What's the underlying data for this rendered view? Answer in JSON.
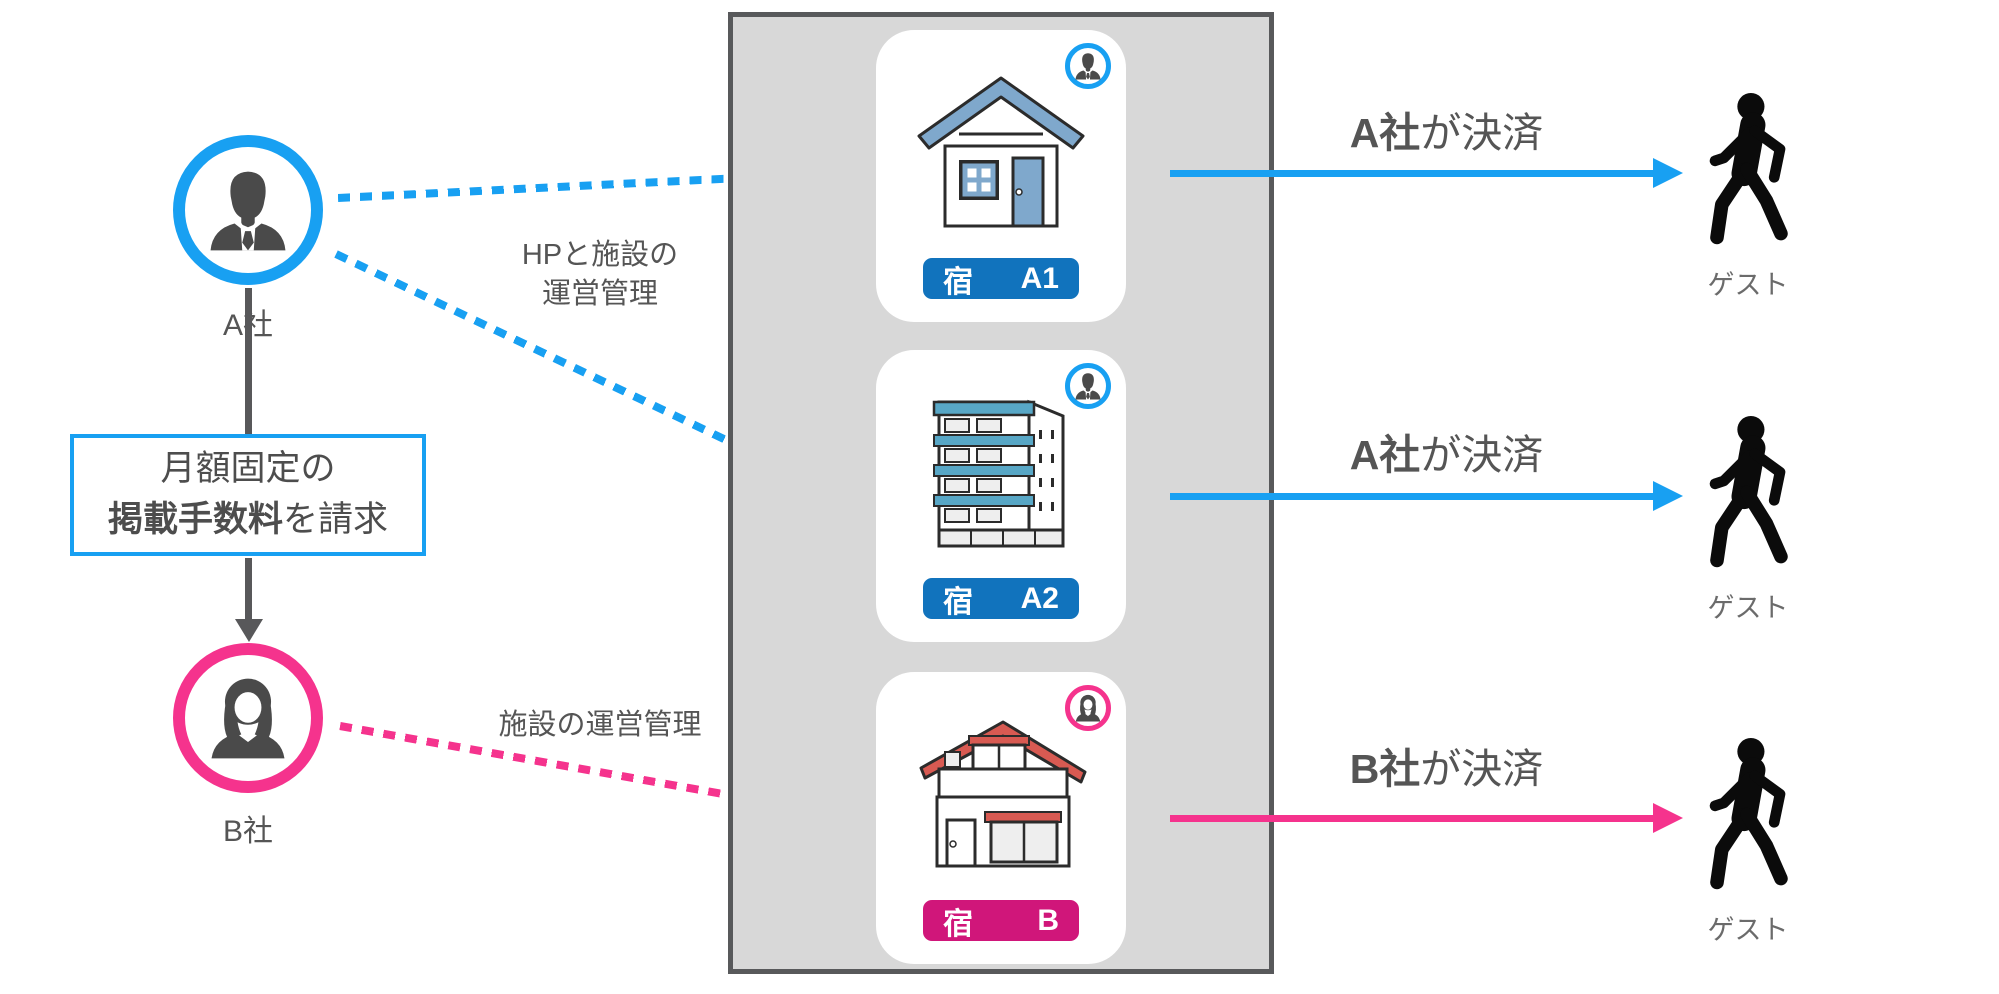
{
  "colors": {
    "blue": "#18A0F2",
    "pink": "#F5338D",
    "pill_blue": "#1173BD",
    "pill_pink": "#D0167A",
    "panel_bg": "#D8D8D8",
    "panel_border": "#58595B",
    "roof_blue": "#7FA8CC",
    "building_teal": "#58A7C6",
    "roof_red": "#D85A52",
    "text_dark": "#4D4D4D",
    "text_gray": "#6B6B6B"
  },
  "left": {
    "company_a_label": "A社",
    "company_b_label": "B社",
    "fee_box": {
      "line1": "月額固定の",
      "line2_bold": "掲載手数料",
      "line2_rest": "を請求"
    },
    "arrow_a_label_line1": "HPと施設の",
    "arrow_a_label_line2": "運営管理",
    "arrow_b_label": "施設の運営管理"
  },
  "properties": [
    {
      "pill_prefix": "宿",
      "pill_name": "A1",
      "owner": "A社"
    },
    {
      "pill_prefix": "宿",
      "pill_name": "A2",
      "owner": "A社"
    },
    {
      "pill_prefix": "宿",
      "pill_name": "B",
      "owner": "B社"
    }
  ],
  "settlements": [
    {
      "company": "A社",
      "suffix": "が決済",
      "guest_label": "ゲスト"
    },
    {
      "company": "A社",
      "suffix": "が決済",
      "guest_label": "ゲスト"
    },
    {
      "company": "B社",
      "suffix": "が決済",
      "guest_label": "ゲスト"
    }
  ]
}
